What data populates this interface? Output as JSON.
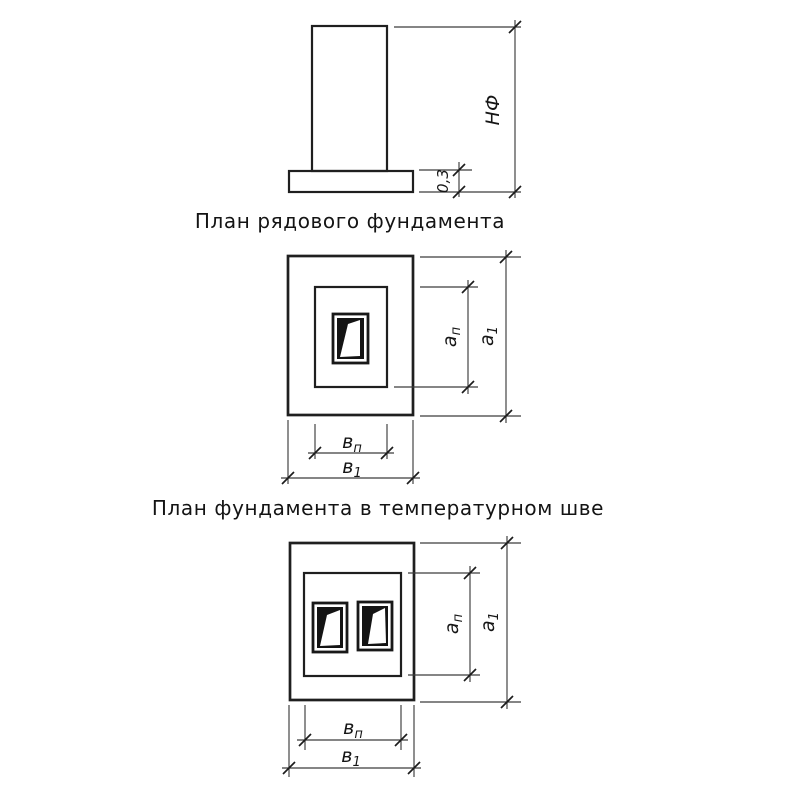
{
  "page": {
    "background_color": "#ffffff",
    "ink_color": "#1c1c1c"
  },
  "elevation": {
    "height_dim_label": "НФ",
    "footing_thickness_label": "0,3"
  },
  "dim_labels": {
    "pedestal_depth": {
      "base": "а",
      "sub": "п"
    },
    "footing_depth": {
      "base": "а",
      "sub": "1"
    },
    "pedestal_width": {
      "base": "в",
      "sub": "п"
    },
    "footing_width": {
      "base": "в",
      "sub": "1"
    }
  },
  "plan_single": {
    "caption": "План рядового фундамента"
  },
  "plan_double": {
    "caption": "План фундамента в температурном шве"
  }
}
